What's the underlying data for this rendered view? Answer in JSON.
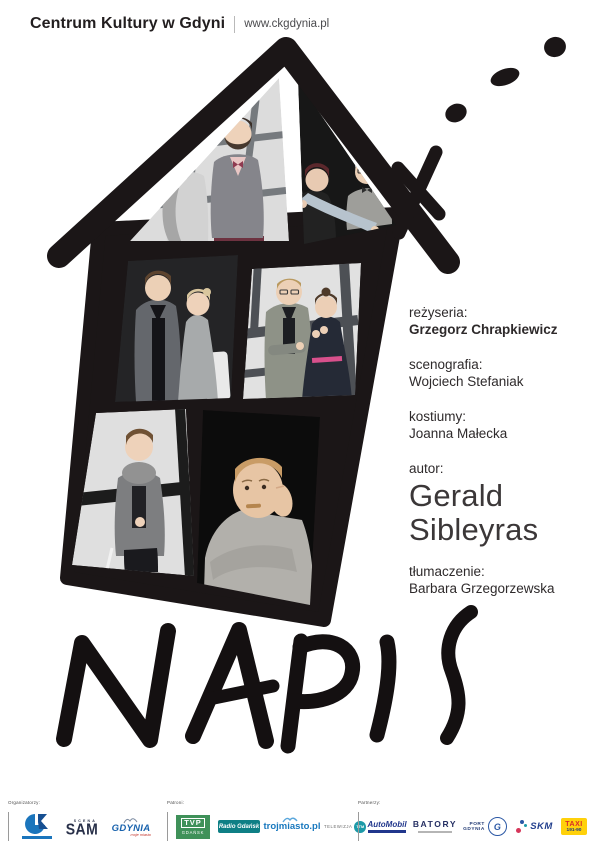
{
  "header": {
    "title": "Centrum Kultury w Gdyni",
    "url": "www.ckgdynia.pl"
  },
  "title": "NAPIS",
  "credits": {
    "rezyseria_label": "reżyseria:",
    "rezyseria": "Grzegorz Chrapkiewicz",
    "scenografia_label": "scenografia:",
    "scenografia": "Wojciech Stefaniak",
    "kostiumy_label": "kostiumy:",
    "kostiumy": "Joanna Małecka",
    "autor_label": "autor:",
    "autor_first": "Gerald",
    "autor_last": "Sibleyras",
    "tlumaczenie_label": "tłumaczenie:",
    "tlumaczenie": "Barbara Grzegorzewska"
  },
  "footer": {
    "organizers_label": "Organizatorzy:",
    "patrons_label": "Patroni:",
    "partners_label": "Partnerzy:",
    "logos": {
      "sam": {
        "scena": "SCENA",
        "sam": "SAM"
      },
      "gdynia": {
        "main": "GDYNIA",
        "sub": "moje miasto"
      },
      "tvp": {
        "main": "TVP",
        "sub": "GDAŃSK"
      },
      "radio": {
        "text": "Radio Gdańsk"
      },
      "trojmiasto": {
        "text": "trojmiasto.pl"
      },
      "ttm": {
        "text": "TELEWIZJA",
        "badge": "TTM"
      },
      "automobil": {
        "text": "AutoMobil"
      },
      "batory": {
        "text": "BATORY"
      },
      "port": {
        "line1": "PORT",
        "line2": "GDYNIA",
        "badge": "G"
      },
      "skm": {
        "text": "SKM"
      },
      "taxi": {
        "line1": "TAXI",
        "line2": "191-90"
      }
    }
  },
  "colors": {
    "poster_black": "#1b1617",
    "ck_blue": "#1b75bc",
    "tvp_green": "#3f9159",
    "radio_teal": "#0e7f85",
    "trojmiasto_blue": "#1878be",
    "ttm_teal": "#1c9aa8",
    "taxi_yellow": "#ffd10a"
  }
}
